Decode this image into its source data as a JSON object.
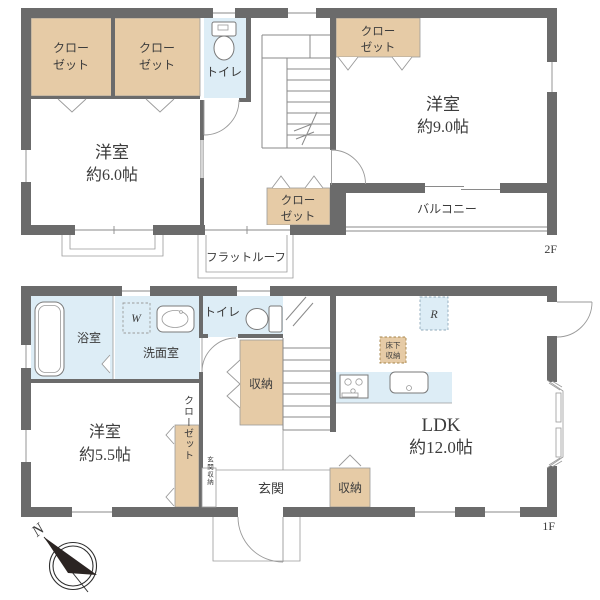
{
  "floor2": {
    "label": "2F",
    "closet_left_a": {
      "l1": "クロー",
      "l2": "ゼット"
    },
    "closet_left_b": {
      "l1": "クロー",
      "l2": "ゼット"
    },
    "toilet": "トイレ",
    "closet_right": {
      "l1": "クロー",
      "l2": "ゼット"
    },
    "closet_center": {
      "l1": "クロー",
      "l2": "ゼット"
    },
    "room_west": {
      "name": "洋室",
      "size": "約6.0帖"
    },
    "room_east": {
      "name": "洋室",
      "size": "約9.0帖"
    },
    "balcony": "バルコニー",
    "flat_roof": "フラットルーフ"
  },
  "floor1": {
    "label": "1F",
    "bath": "浴室",
    "washer": "W",
    "washroom": "洗面室",
    "toilet": "トイレ",
    "storage_stair": "収納",
    "storage_entry": "収納",
    "underfloor_storage": {
      "l1": "床下",
      "l2": "収納"
    },
    "fridge": "R",
    "room_west": {
      "name": "洋室",
      "size": "約5.5帖"
    },
    "closet": "クローゼット",
    "entrance_storage": "玄関収納",
    "entrance": "玄関",
    "ldk": {
      "name": "LDK",
      "size": "約12.0帖"
    }
  },
  "compass": {
    "north": "N"
  },
  "colors": {
    "wall": "#6b6b6b",
    "closet_fill": "#e6cba6",
    "water_fill": "#ddedf6",
    "line": "#8a8a8a",
    "text": "#3c3c3c"
  }
}
